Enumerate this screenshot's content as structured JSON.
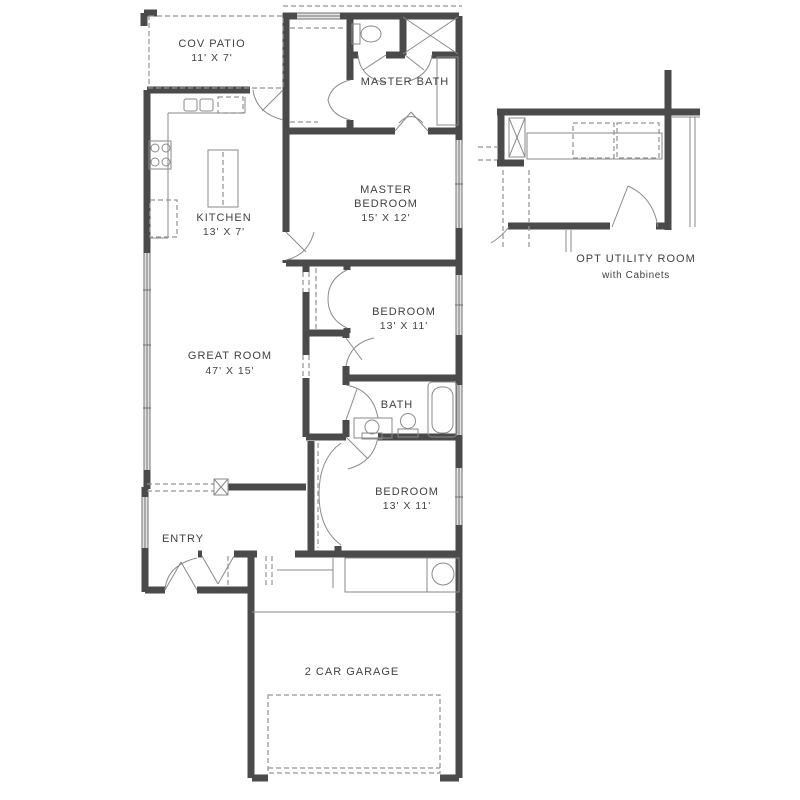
{
  "rooms": {
    "cov_patio": {
      "name": "COV PATIO",
      "dims": "11' X 7'"
    },
    "kitchen": {
      "name": "KITCHEN",
      "dims": "13' X 7'"
    },
    "master_bath": {
      "name": "MASTER BATH"
    },
    "master_bedroom": {
      "l1": "MASTER",
      "l2": "BEDROOM",
      "dims": "15' X 12'"
    },
    "great_room": {
      "name": "GREAT ROOM",
      "dims": "47' X 15'"
    },
    "bedroom1": {
      "name": "BEDROOM",
      "dims": "13' X 11'"
    },
    "bath": {
      "name": "BATH"
    },
    "bedroom2": {
      "name": "BEDROOM",
      "dims": "13' X 11'"
    },
    "entry": {
      "name": "ENTRY"
    },
    "garage": {
      "name": "2 CAR GARAGE"
    }
  },
  "inset": {
    "title": "OPT UTILITY ROOM",
    "subtitle": "with Cabinets"
  },
  "colors": {
    "background": "#ffffff",
    "wall_edge": "#4a4a4a",
    "wall_fill": "#d4d4d4",
    "thin_line": "#8a8a8a",
    "dashed_line": "#939393",
    "text": "#414141"
  }
}
